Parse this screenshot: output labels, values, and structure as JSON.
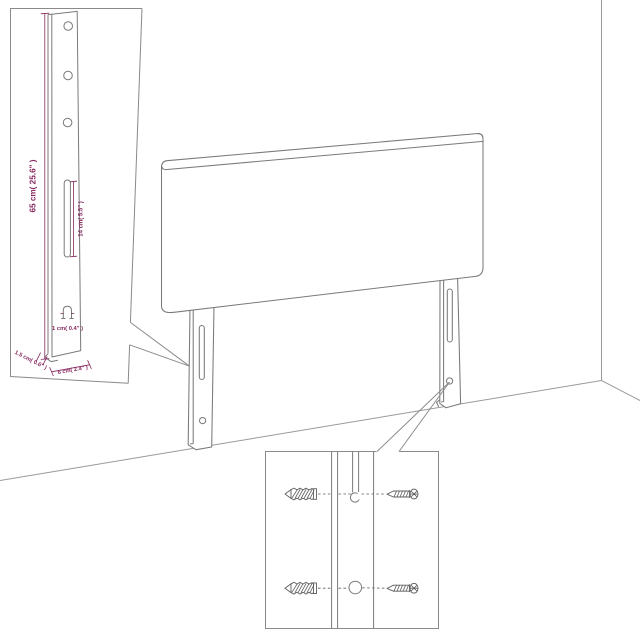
{
  "figure": {
    "type": "product-dimension-diagram",
    "subject": "Headboard with two mounting legs in a room corner; enlarged leg inset with dimensions and wall-fixing hardware inset with plugs and screws",
    "colors": {
      "background": "#ffffff",
      "line_art": "#7a7a7a",
      "room_lines": "#9a9a9a",
      "hardware": "#5f5f5f",
      "dimensions": "#87295f"
    },
    "leg_inset": {
      "height_label": "65 cm( 25.6\" )",
      "slot_label": "14 cm( 5.5\" )",
      "hook_label": "1 cm( 0.4\" )",
      "side_label": "1.5 cm( 0.6\" )",
      "width_label": "6 cm( 2.4\" )"
    },
    "hardware_inset": {
      "items": [
        "wall-plug",
        "screw",
        "wall-plug",
        "screw"
      ]
    }
  }
}
